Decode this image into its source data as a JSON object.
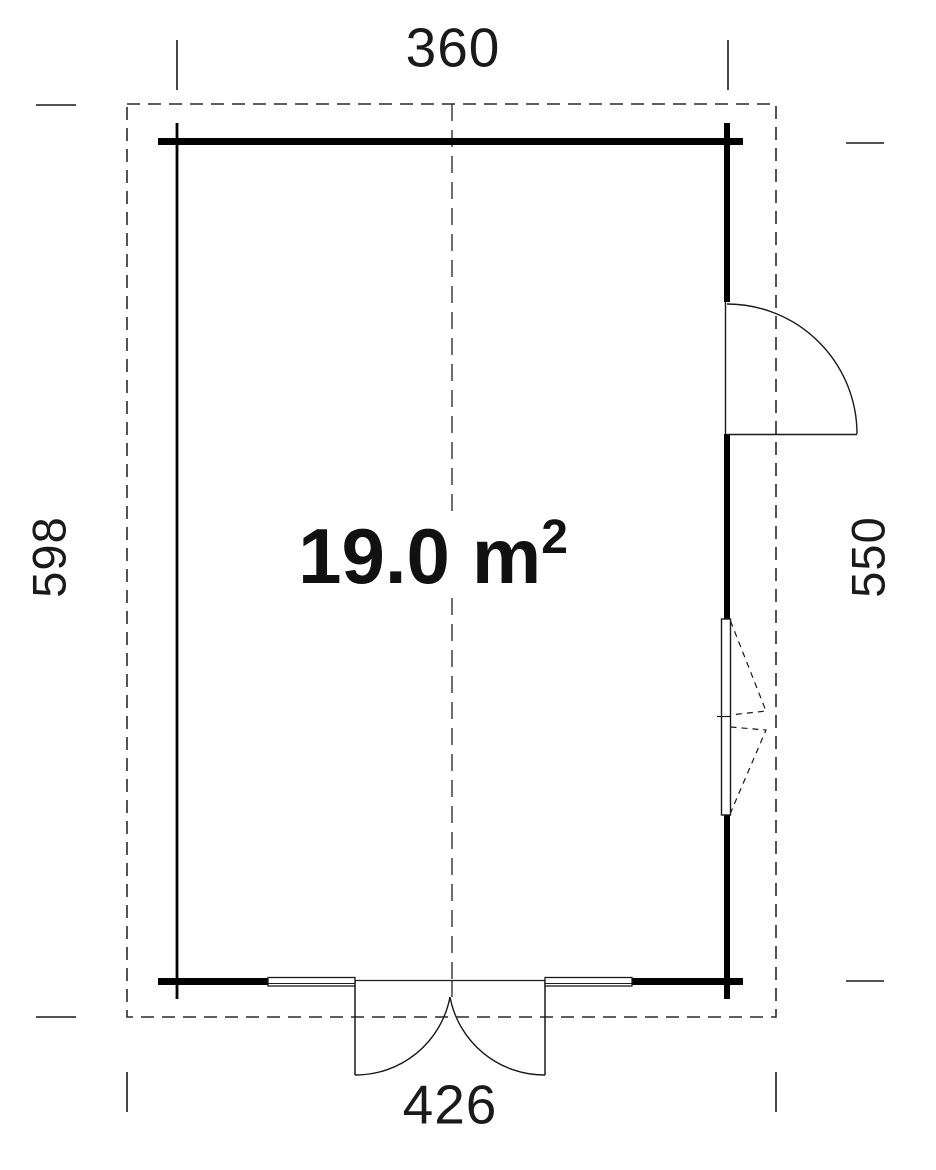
{
  "plan": {
    "type": "floor-plan",
    "area_label": {
      "value": "19.0",
      "unit": "m",
      "exponent": "2"
    },
    "dimensions": {
      "top": "360",
      "bottom": "426",
      "left": "598",
      "right": "550"
    },
    "colors": {
      "line": "#1a1a1a",
      "wall": "#000000",
      "background": "#ffffff"
    },
    "features": {
      "outer_outline": "roof-overhang-dashed-outline",
      "center_line": "building-center-dashed-line",
      "right_door": "single-swing-door",
      "bottom_door": "double-swing-door",
      "right_window": "double-casement-window",
      "bottom_glazing": "fixed-glazing-panels"
    }
  }
}
